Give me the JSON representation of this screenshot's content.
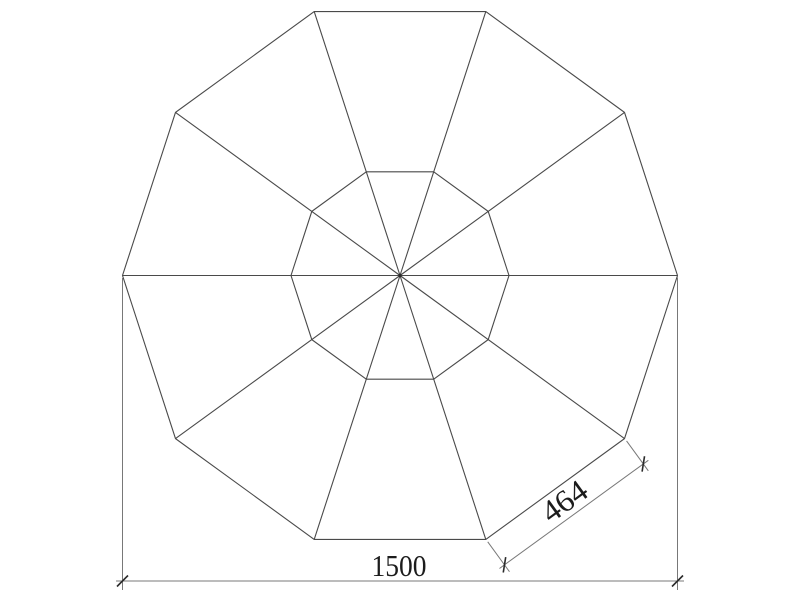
{
  "drawing": {
    "background_color": "#ffffff",
    "colors": {
      "object_line": "#4a4a4a",
      "dimension_line": "#787878",
      "tick": "#2a2a2a",
      "text": "#1c1c1c"
    },
    "shape": {
      "description": "regular ten-sided (decagon) roof/umbrella plan with inner decagon hub and radial rib lines from center to each outer vertex",
      "sides": 10
    },
    "dimensions": {
      "overall_width": {
        "value": "1500"
      },
      "panel_edge": {
        "value": "464"
      }
    }
  }
}
